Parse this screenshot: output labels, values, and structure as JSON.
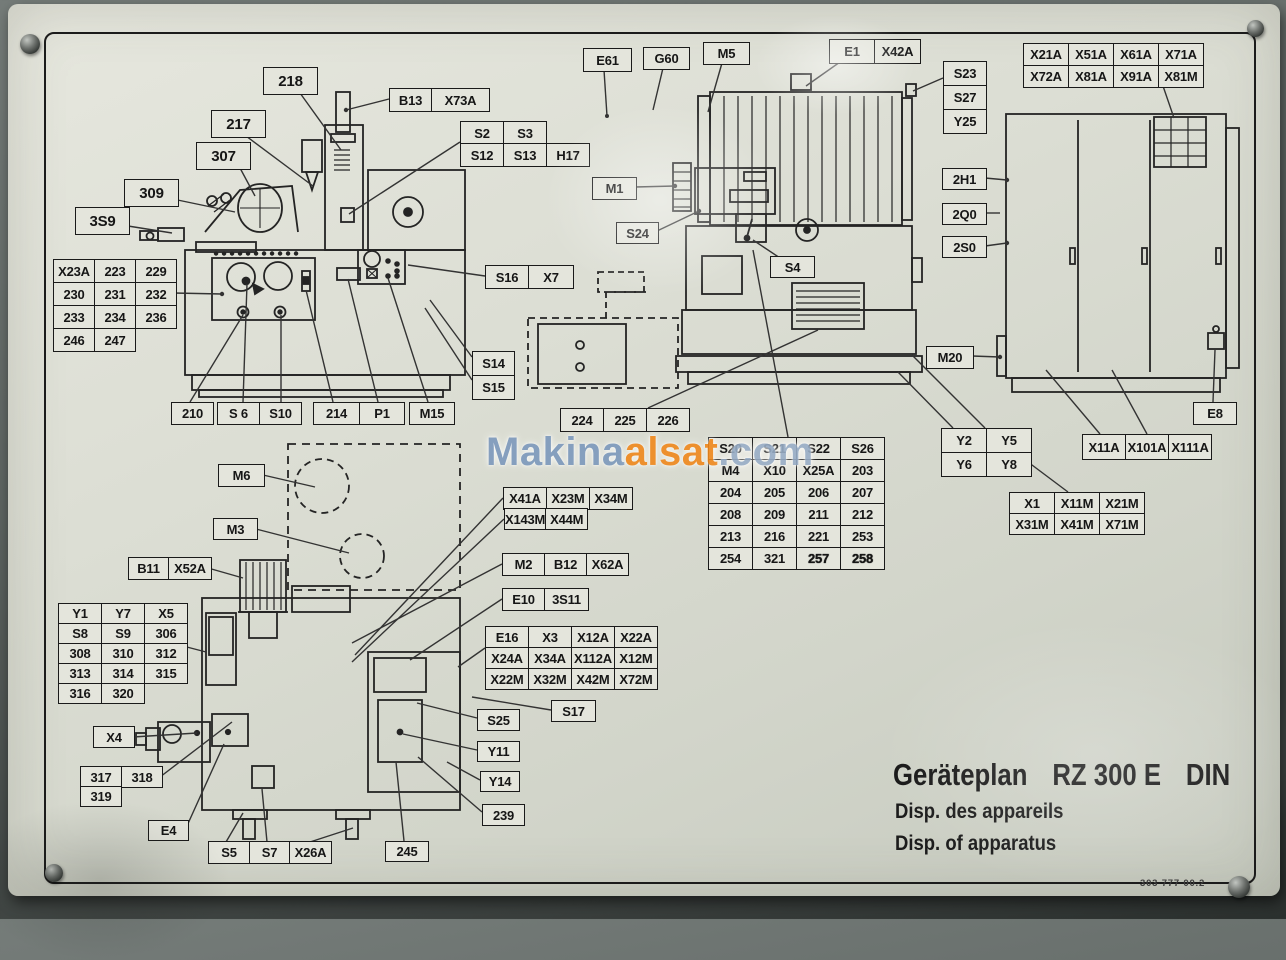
{
  "watermark": {
    "parts": [
      {
        "text": "Makina",
        "color": "#7d99bc"
      },
      {
        "text": "alsat",
        "color": "#f0881d"
      },
      {
        "text": ".com",
        "color": "#98adc6"
      }
    ]
  },
  "title_block": {
    "title": "Geräteplan",
    "model": "RZ 300 E",
    "standard": "DIN",
    "subtitle_fr": "Disp. des appareils",
    "subtitle_en": "Disp. of apparatus",
    "doc_number": "303 777 00.2"
  },
  "boxes": [
    {
      "name": "label-218",
      "x": 263,
      "y": 67,
      "cw": 53,
      "rh": 26,
      "fs": 15,
      "rows": [
        [
          "218"
        ]
      ]
    },
    {
      "name": "label-217",
      "x": 211,
      "y": 110,
      "cw": 53,
      "rh": 26,
      "fs": 15,
      "rows": [
        [
          "217"
        ]
      ]
    },
    {
      "name": "label-307",
      "x": 196,
      "y": 142,
      "cw": 53,
      "rh": 26,
      "fs": 15,
      "rows": [
        [
          "307"
        ]
      ]
    },
    {
      "name": "label-309",
      "x": 124,
      "y": 179,
      "cw": 53,
      "rh": 26,
      "fs": 15,
      "rows": [
        [
          "309"
        ]
      ]
    },
    {
      "name": "label-3s9",
      "x": 75,
      "y": 207,
      "cw": 53,
      "rh": 26,
      "fs": 15,
      "rows": [
        [
          "3S9"
        ]
      ]
    },
    {
      "name": "label-b13-x73a",
      "x": 389,
      "y": 88,
      "cws": [
        41,
        57
      ],
      "rh": 22,
      "rows": [
        [
          "B13",
          "X73A"
        ]
      ]
    },
    {
      "name": "label-s2-s3",
      "x": 460,
      "y": 121,
      "cw": 42,
      "rh": 22,
      "rows": [
        [
          "S2",
          "S3"
        ]
      ]
    },
    {
      "name": "label-s12-s13-h17",
      "x": 460,
      "y": 143,
      "cw": 42,
      "rh": 22,
      "rows": [
        [
          "S12",
          "S13",
          "H17"
        ]
      ]
    },
    {
      "name": "table-x23a",
      "x": 53,
      "y": 259,
      "cw": 40,
      "rh": 22,
      "rows": [
        [
          "X23A",
          "223",
          "229"
        ],
        [
          "230",
          "231",
          "232"
        ],
        [
          "233",
          "234",
          "236"
        ],
        [
          "246",
          "247"
        ]
      ]
    },
    {
      "name": "label-210",
      "x": 171,
      "y": 402,
      "cw": 41,
      "rh": 21,
      "rows": [
        [
          "210"
        ]
      ]
    },
    {
      "name": "label-s6-s10",
      "x": 217,
      "y": 402,
      "cw": 41,
      "rh": 21,
      "rows": [
        [
          "S 6",
          "S10"
        ]
      ]
    },
    {
      "name": "label-214",
      "x": 313,
      "y": 402,
      "cw": 45,
      "rh": 21,
      "rows": [
        [
          "214"
        ]
      ]
    },
    {
      "name": "label-p1",
      "x": 359,
      "y": 402,
      "cw": 44,
      "rh": 21,
      "rows": [
        [
          "P1"
        ]
      ]
    },
    {
      "name": "label-m15",
      "x": 409,
      "y": 402,
      "cw": 44,
      "rh": 21,
      "rows": [
        [
          "M15"
        ]
      ]
    },
    {
      "name": "label-s16-x7",
      "x": 485,
      "y": 265,
      "cws": [
        42,
        44
      ],
      "rh": 22,
      "rows": [
        [
          "S16",
          "X7"
        ]
      ]
    },
    {
      "name": "table-s14-s15",
      "x": 472,
      "y": 351,
      "cw": 41,
      "rh": 23,
      "rows": [
        [
          "S14"
        ],
        [
          "S15"
        ]
      ]
    },
    {
      "name": "label-e61",
      "x": 583,
      "y": 48,
      "cw": 47,
      "rh": 22,
      "rows": [
        [
          "E61"
        ]
      ]
    },
    {
      "name": "label-g60",
      "x": 643,
      "y": 47,
      "cw": 45,
      "rh": 21,
      "rows": [
        [
          "G60"
        ]
      ]
    },
    {
      "name": "label-m5",
      "x": 703,
      "y": 42,
      "cw": 45,
      "rh": 21,
      "rows": [
        [
          "M5"
        ]
      ]
    },
    {
      "name": "label-e1-x42a",
      "x": 829,
      "y": 39,
      "cws": [
        44,
        45
      ],
      "rh": 23,
      "rows": [
        [
          "E1",
          "X42A"
        ]
      ]
    },
    {
      "name": "table-s23-s27-y25",
      "x": 943,
      "y": 61,
      "cw": 42,
      "rh": 23,
      "rows": [
        [
          "S23"
        ],
        [
          "S27"
        ],
        [
          "Y25"
        ]
      ]
    },
    {
      "name": "label-m1",
      "x": 592,
      "y": 177,
      "cw": 43,
      "rh": 21,
      "rows": [
        [
          "M1"
        ]
      ]
    },
    {
      "name": "label-s24",
      "x": 616,
      "y": 222,
      "cw": 41,
      "rh": 20,
      "rows": [
        [
          "S24"
        ]
      ]
    },
    {
      "name": "label-s4",
      "x": 770,
      "y": 256,
      "cw": 43,
      "rh": 20,
      "rows": [
        [
          "S4"
        ]
      ]
    },
    {
      "name": "label-224-225-226",
      "x": 560,
      "y": 408,
      "cw": 42,
      "rh": 22,
      "rows": [
        [
          "224",
          "225",
          "226"
        ]
      ]
    },
    {
      "name": "table-s20",
      "x": 708,
      "y": 437,
      "cw": 43,
      "rh": 21,
      "bold": [
        "257",
        "258"
      ],
      "rows": [
        [
          "S20",
          "S21",
          "S22",
          "S26"
        ],
        [
          "M4",
          "X10",
          "X25A",
          "203"
        ],
        [
          "204",
          "205",
          "206",
          "207"
        ],
        [
          "208",
          "209",
          "211",
          "212"
        ],
        [
          "213",
          "216",
          "221",
          "253"
        ],
        [
          "254",
          "321",
          "257",
          "258"
        ]
      ]
    },
    {
      "name": "table-y2-y5-y6-y8",
      "x": 941,
      "y": 428,
      "cw": 44,
      "rh": 23,
      "rows": [
        [
          "Y2",
          "Y5"
        ],
        [
          "Y6",
          "Y8"
        ]
      ]
    },
    {
      "name": "label-x11a-x101a-x111a",
      "x": 1082,
      "y": 434,
      "cw": 42,
      "rh": 24,
      "rows": [
        [
          "X11A",
          "X101A",
          "X111A"
        ]
      ]
    },
    {
      "name": "table-x1",
      "x": 1009,
      "y": 492,
      "cw": 44,
      "rh": 20,
      "rows": [
        [
          "X1",
          "X11M",
          "X21M"
        ],
        [
          "X31M",
          "X41M",
          "X71M"
        ]
      ]
    },
    {
      "name": "table-x21a",
      "x": 1023,
      "y": 43,
      "cw": 44,
      "rh": 21,
      "rows": [
        [
          "X21A",
          "X51A",
          "X61A",
          "X71A"
        ],
        [
          "X72A",
          "X81A",
          "X91A",
          "X81M"
        ]
      ]
    },
    {
      "name": "label-2h1",
      "x": 942,
      "y": 168,
      "cw": 43,
      "rh": 20,
      "rows": [
        [
          "2H1"
        ]
      ]
    },
    {
      "name": "label-2q0",
      "x": 942,
      "y": 203,
      "cw": 43,
      "rh": 20,
      "rows": [
        [
          "2Q0"
        ]
      ]
    },
    {
      "name": "label-2s0",
      "x": 942,
      "y": 236,
      "cw": 43,
      "rh": 20,
      "rows": [
        [
          "2S0"
        ]
      ]
    },
    {
      "name": "label-m20",
      "x": 926,
      "y": 346,
      "cw": 46,
      "rh": 21,
      "rows": [
        [
          "M20"
        ]
      ]
    },
    {
      "name": "label-e8",
      "x": 1193,
      "y": 402,
      "cw": 42,
      "rh": 21,
      "rows": [
        [
          "E8"
        ]
      ]
    },
    {
      "name": "label-m6",
      "x": 218,
      "y": 464,
      "cw": 45,
      "rh": 21,
      "rows": [
        [
          "M6"
        ]
      ]
    },
    {
      "name": "label-m3",
      "x": 213,
      "y": 518,
      "cw": 43,
      "rh": 20,
      "rows": [
        [
          "M3"
        ]
      ]
    },
    {
      "name": "label-b11-x52a",
      "x": 128,
      "y": 557,
      "cws": [
        39,
        42
      ],
      "rh": 21,
      "rows": [
        [
          "B11",
          "X52A"
        ]
      ]
    },
    {
      "name": "label-x41a-x23m-x34m",
      "x": 503,
      "y": 487,
      "cw": 42,
      "rh": 21,
      "rows": [
        [
          "X41A",
          "X23M",
          "X34M"
        ]
      ]
    },
    {
      "name": "label-x143m-x44m",
      "x": 504,
      "y": 508,
      "cws": [
        39,
        41
      ],
      "rh": 20,
      "rows": [
        [
          "X143M",
          "X44M"
        ]
      ]
    },
    {
      "name": "label-m2-b12-x62a",
      "x": 502,
      "y": 553,
      "cw": 41,
      "rh": 21,
      "rows": [
        [
          "M2",
          "B12",
          "X62A"
        ]
      ]
    },
    {
      "name": "label-e10-3s11",
      "x": 502,
      "y": 588,
      "cws": [
        41,
        43
      ],
      "rh": 21,
      "rows": [
        [
          "E10",
          "3S11"
        ]
      ]
    },
    {
      "name": "table-e16",
      "x": 485,
      "y": 626,
      "cw": 42,
      "rh": 20,
      "rows": [
        [
          "E16",
          "X3",
          "X12A",
          "X22A"
        ],
        [
          "X24A",
          "X34A",
          "X112A",
          "X12M"
        ],
        [
          "X22M",
          "X32M",
          "X42M",
          "X72M"
        ]
      ]
    },
    {
      "name": "table-y1",
      "x": 58,
      "y": 603,
      "cw": 42,
      "rh": 19,
      "rows": [
        [
          "Y1",
          "Y7",
          "X5"
        ],
        [
          "S8",
          "S9",
          "306"
        ],
        [
          "308",
          "310",
          "312"
        ],
        [
          "313",
          "314",
          "315"
        ],
        [
          "316",
          "320"
        ]
      ]
    },
    {
      "name": "label-x4",
      "x": 93,
      "y": 726,
      "cw": 40,
      "rh": 20,
      "rows": [
        [
          "X4"
        ]
      ]
    },
    {
      "name": "label-317-318",
      "x": 80,
      "y": 766,
      "cw": 40,
      "rh": 20,
      "rows": [
        [
          "317",
          "318"
        ]
      ]
    },
    {
      "name": "label-319",
      "x": 80,
      "y": 786,
      "cw": 40,
      "rh": 19,
      "rows": [
        [
          "319"
        ]
      ]
    },
    {
      "name": "label-e4",
      "x": 148,
      "y": 820,
      "cw": 39,
      "rh": 19,
      "rows": [
        [
          "E4"
        ]
      ]
    },
    {
      "name": "label-s5-s7-x26a",
      "x": 208,
      "y": 841,
      "cws": [
        40,
        39,
        41
      ],
      "rh": 21,
      "rows": [
        [
          "S5",
          "S7",
          "X26A"
        ]
      ]
    },
    {
      "name": "label-s25",
      "x": 477,
      "y": 709,
      "cw": 41,
      "rh": 20,
      "rows": [
        [
          "S25"
        ]
      ]
    },
    {
      "name": "label-y11",
      "x": 477,
      "y": 741,
      "cw": 41,
      "rh": 19,
      "rows": [
        [
          "Y11"
        ]
      ]
    },
    {
      "name": "label-y14",
      "x": 480,
      "y": 771,
      "cw": 38,
      "rh": 19,
      "rows": [
        [
          "Y14"
        ]
      ]
    },
    {
      "name": "label-239",
      "x": 482,
      "y": 804,
      "cw": 41,
      "rh": 20,
      "rows": [
        [
          "239"
        ]
      ]
    },
    {
      "name": "label-245",
      "x": 385,
      "y": 841,
      "cw": 42,
      "rh": 19,
      "rows": [
        [
          "245"
        ]
      ]
    },
    {
      "name": "label-s17",
      "x": 551,
      "y": 700,
      "cw": 43,
      "rh": 20,
      "rows": [
        [
          "S17"
        ]
      ]
    }
  ]
}
